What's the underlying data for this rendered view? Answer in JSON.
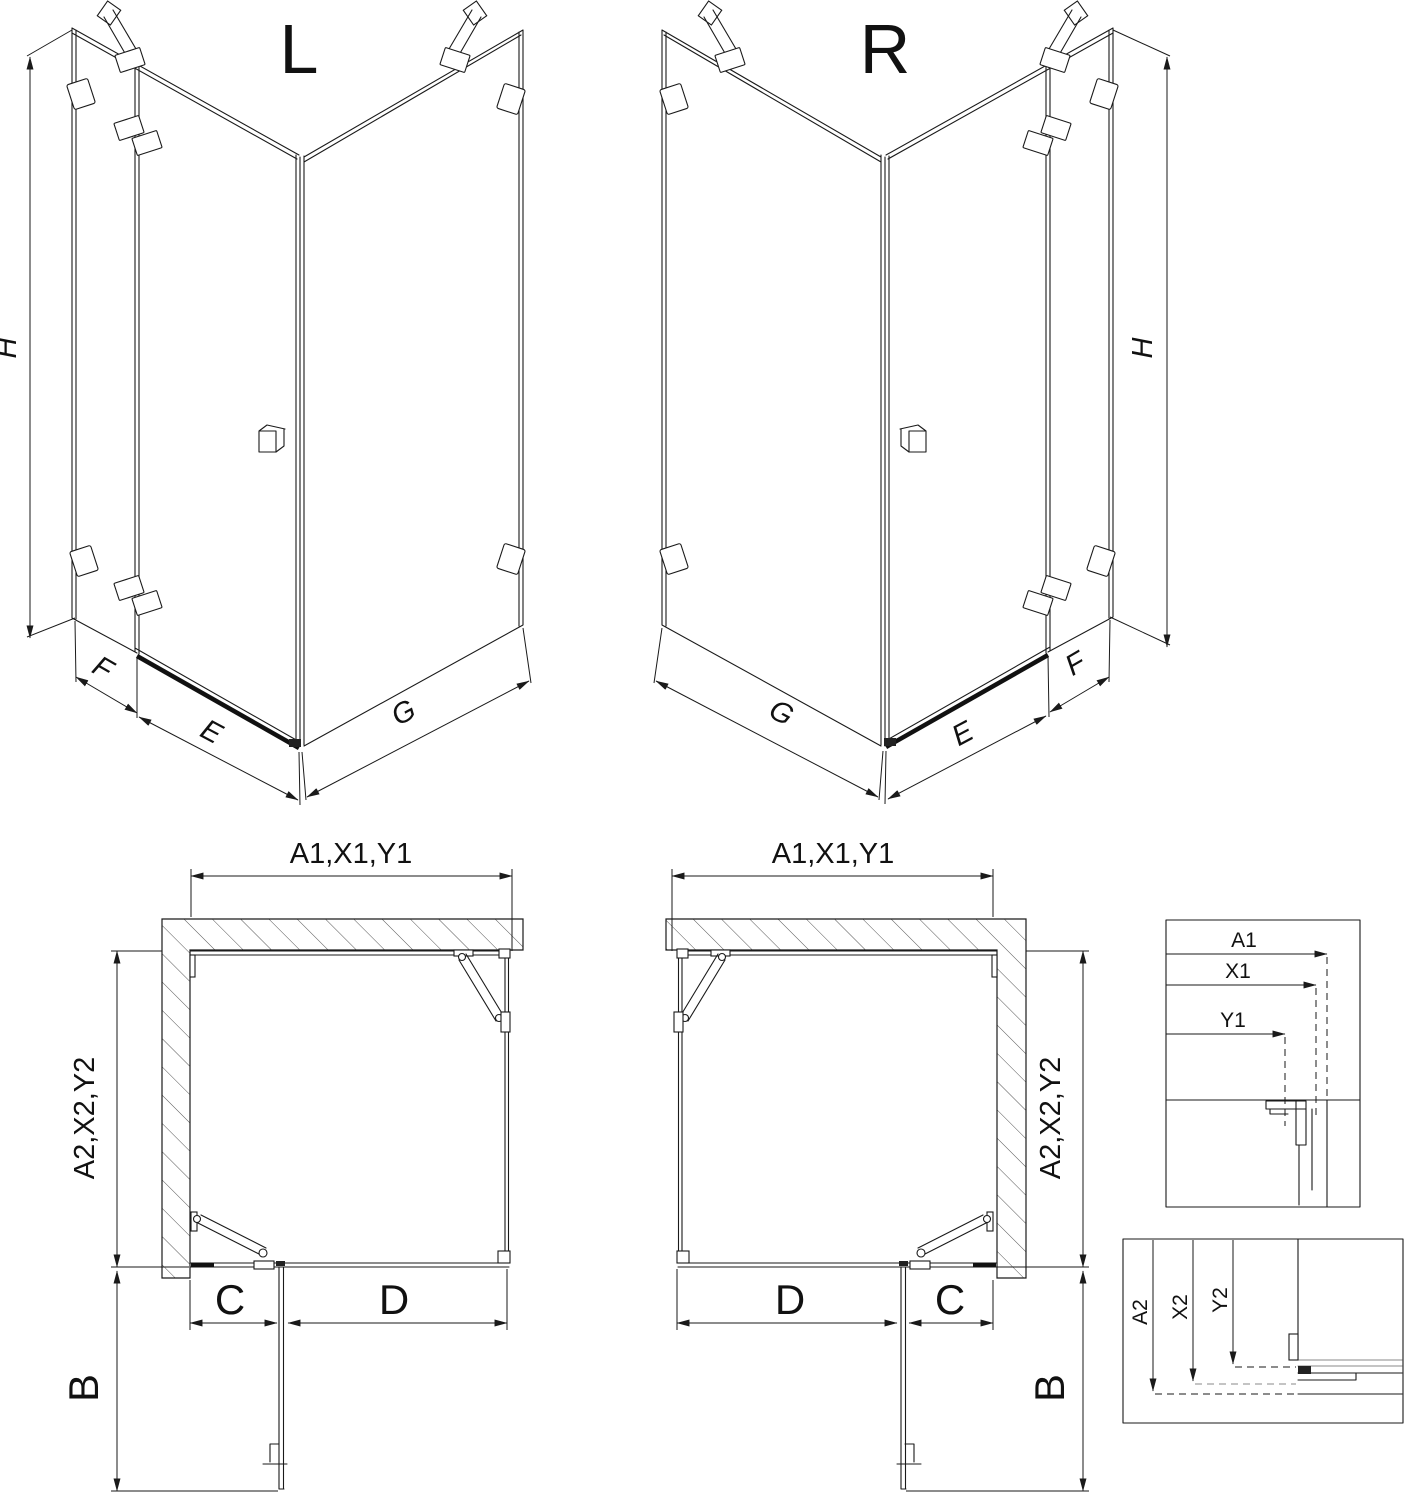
{
  "drawing": {
    "iso_left": {
      "title": "L",
      "dim_height": "H",
      "dim_side_panel": "F",
      "dim_door": "E",
      "dim_fixed_panel": "G"
    },
    "iso_right": {
      "title": "R",
      "dim_height": "H",
      "dim_side_panel": "F",
      "dim_door": "E",
      "dim_fixed_panel": "G"
    },
    "plan_left": {
      "dim_width": "A1,X1,Y1",
      "dim_depth": "A2,X2,Y2",
      "dim_door_open": "B",
      "dim_c": "C",
      "dim_d": "D"
    },
    "plan_right": {
      "dim_width": "A1,X1,Y1",
      "dim_depth": "A2,X2,Y2",
      "dim_door_open": "B",
      "dim_c": "C",
      "dim_d": "D"
    },
    "detail_width": {
      "rows": [
        "A1",
        "X1",
        "Y1"
      ]
    },
    "detail_depth": {
      "rows": [
        "A2",
        "X2",
        "Y2"
      ]
    }
  }
}
